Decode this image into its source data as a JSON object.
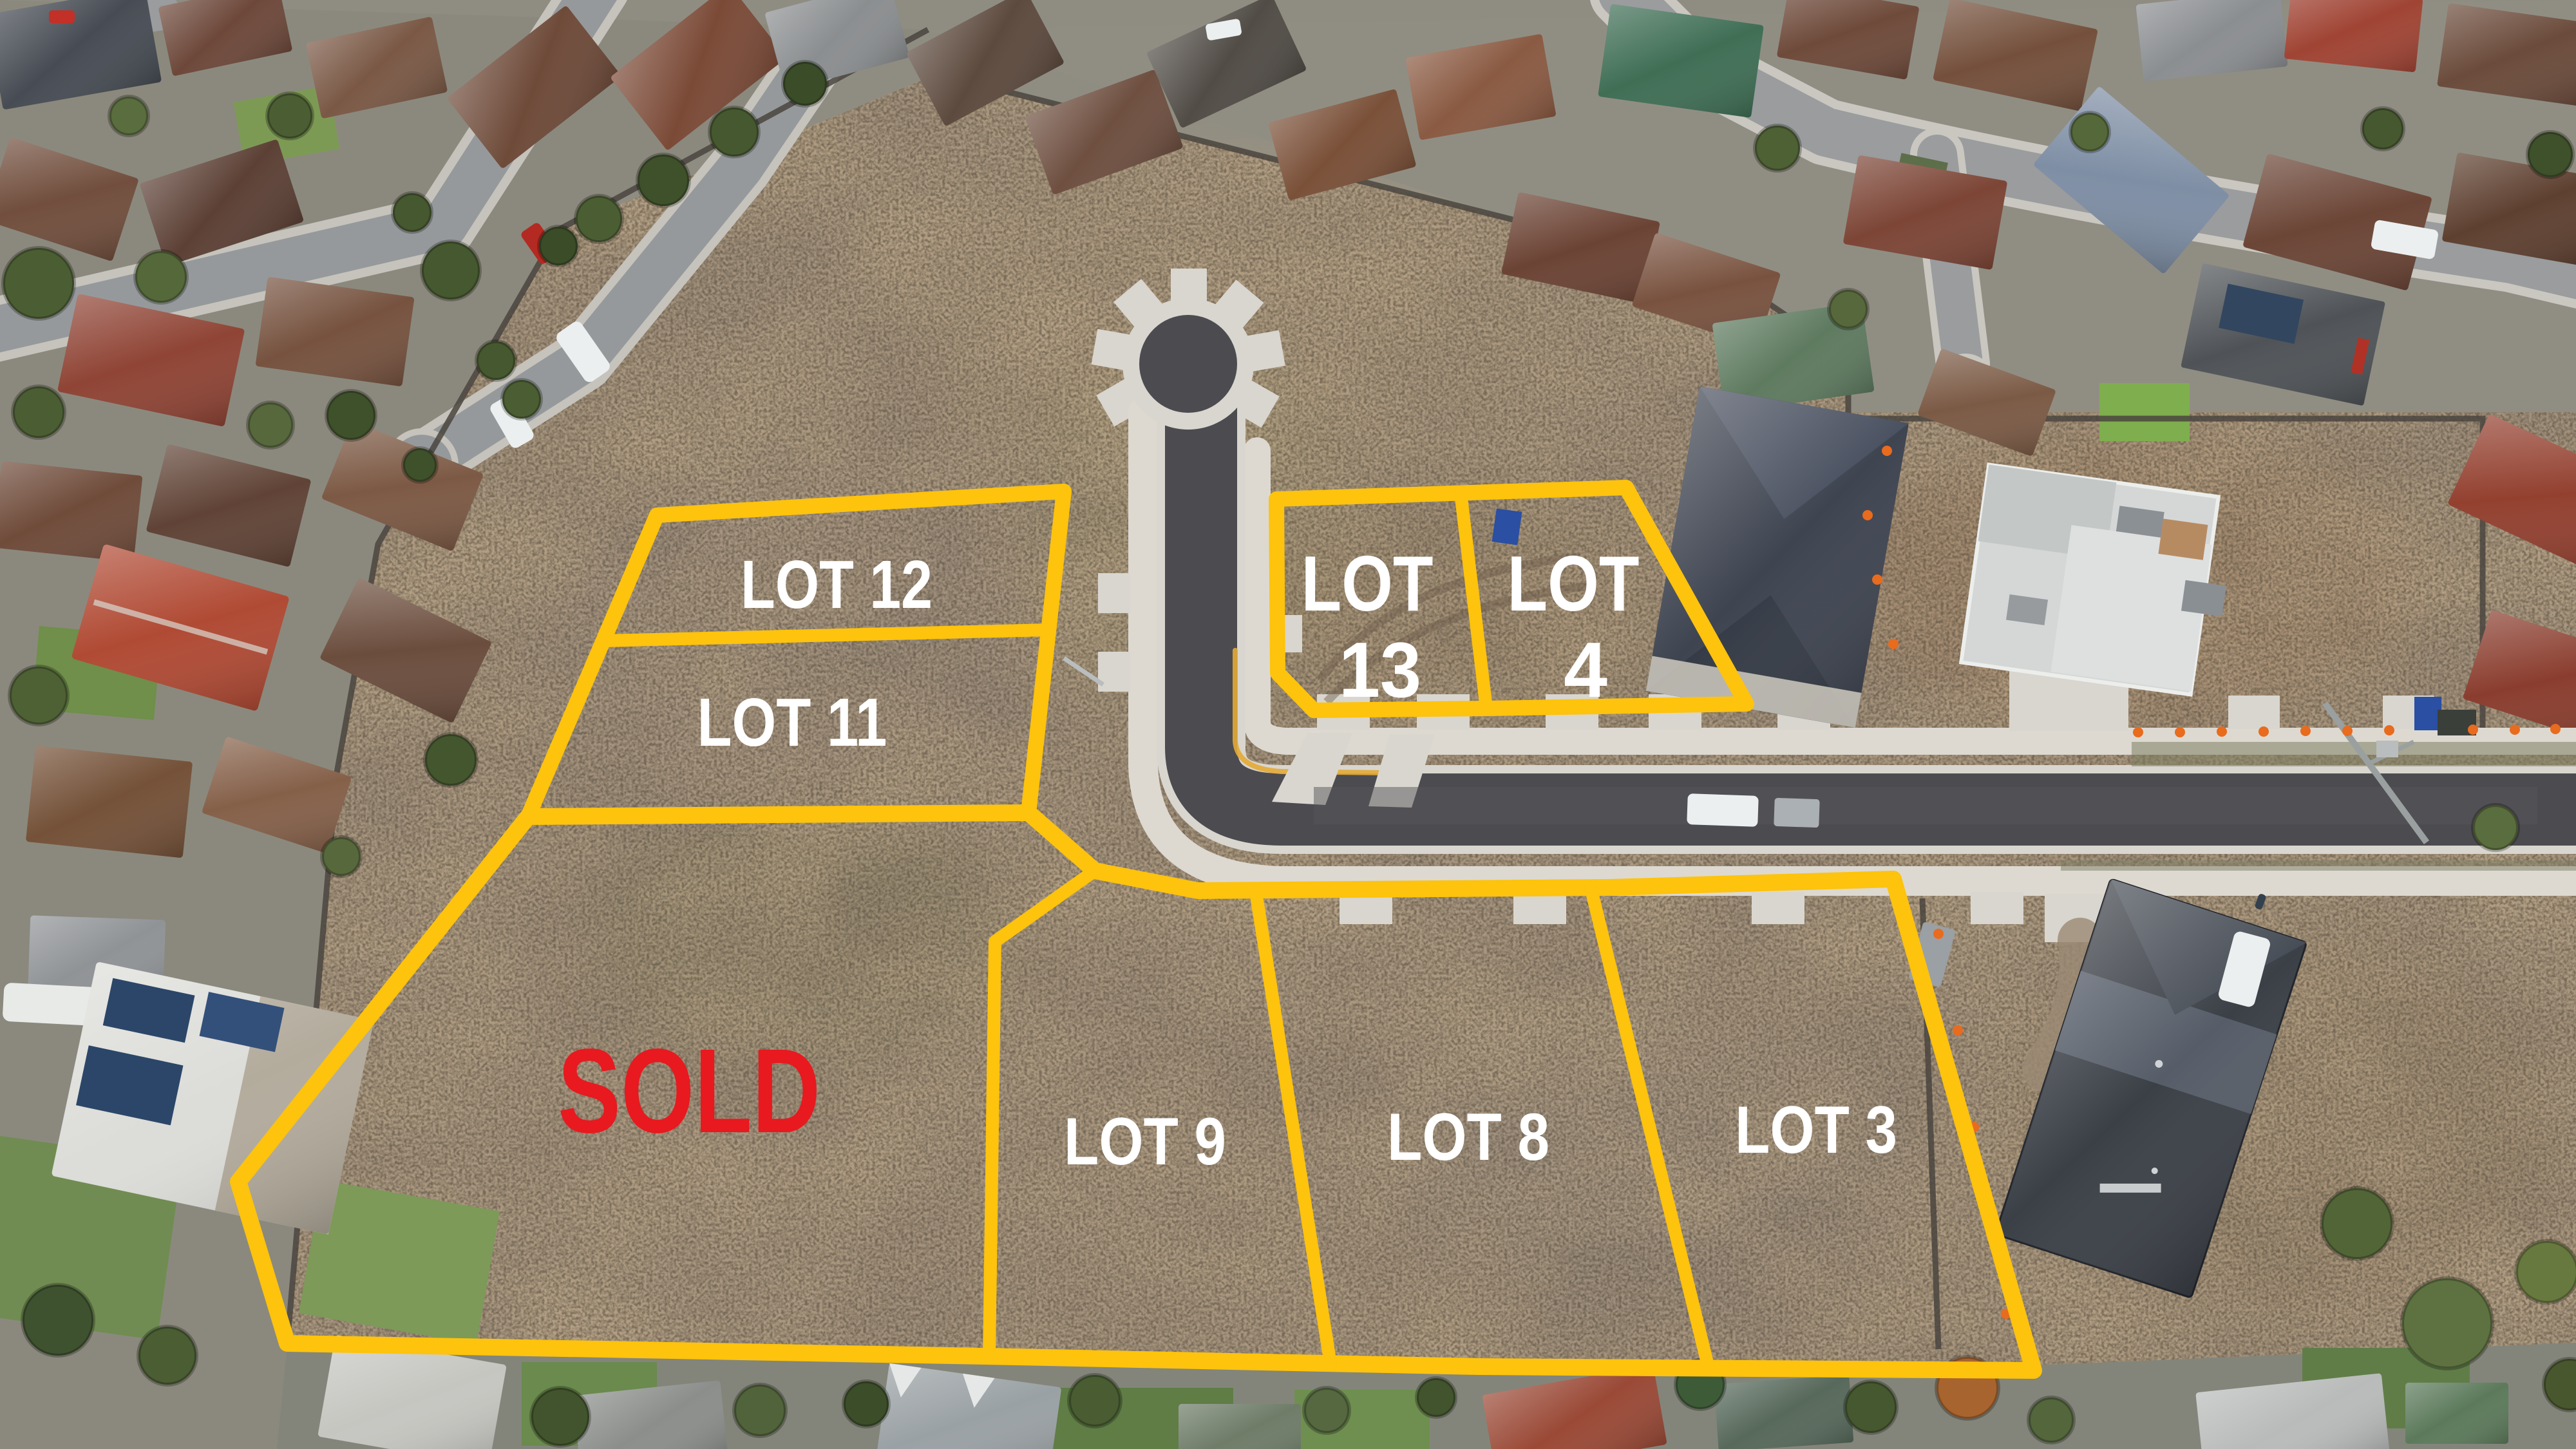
{
  "scene": {
    "type": "aerial-subdivision-lot-map-photo",
    "boundary_color": "#FDC30D",
    "sold_color": "#E8191F",
    "label_color": "#FFFFFF"
  },
  "lots": [
    {
      "id": "lot-12",
      "label": "LOT 12"
    },
    {
      "id": "lot-11",
      "label": "LOT 11"
    },
    {
      "id": "lot-13",
      "label_line_1": "LOT",
      "label_line_2": "13"
    },
    {
      "id": "lot-4",
      "label_line_1": "LOT",
      "label_line_2": "4"
    },
    {
      "id": "lot-9",
      "label": "LOT 9"
    },
    {
      "id": "lot-8",
      "label": "LOT 8"
    },
    {
      "id": "lot-3",
      "label": "LOT 3"
    }
  ],
  "sold_overlay": {
    "label": "SOLD"
  }
}
